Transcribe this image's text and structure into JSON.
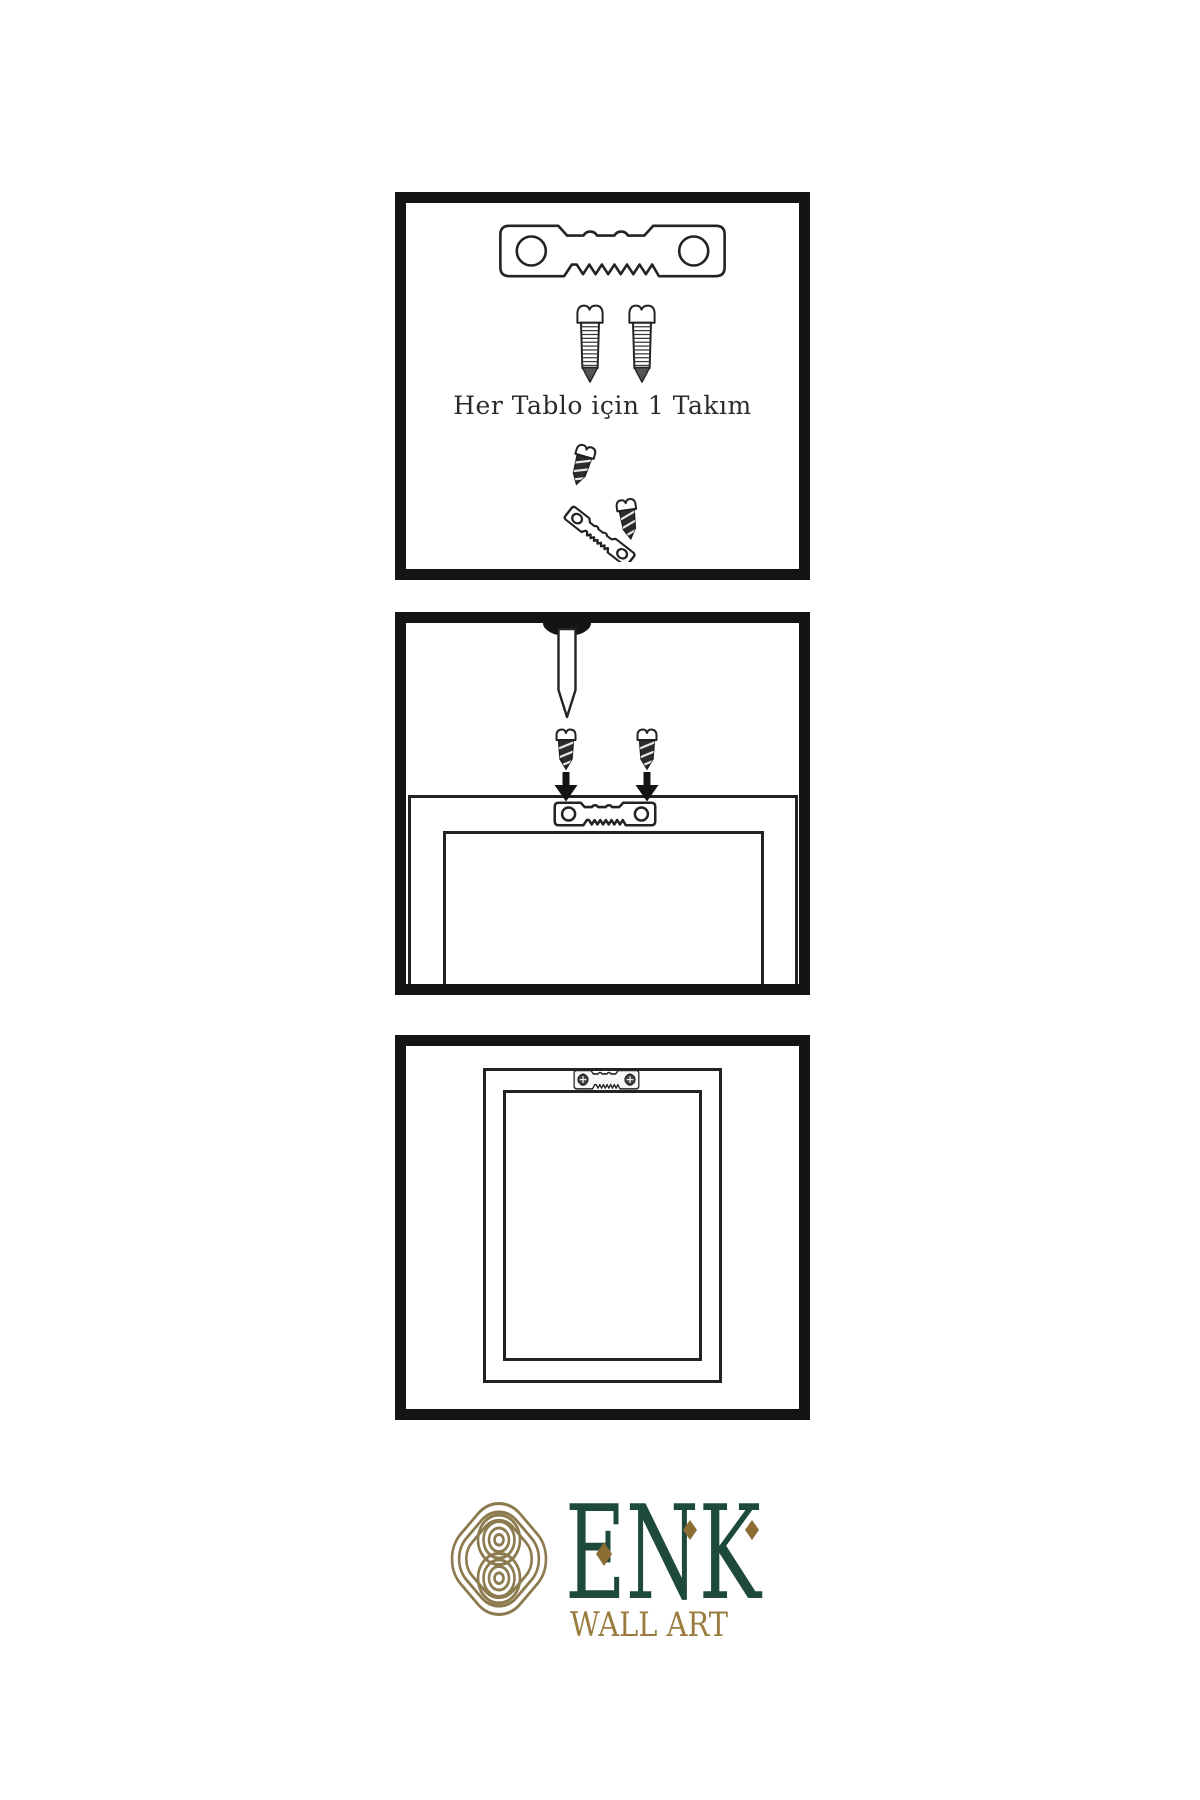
{
  "canvas": {
    "background": "#ffffff",
    "line_color": "#232323",
    "panel_border_color": "#141414"
  },
  "panels": [
    {
      "name": "hardware-kit",
      "caption": "Her Tablo için 1 Takım",
      "items": [
        "sawtooth-hanger",
        "screw",
        "screw",
        "screw-hanger-assembly"
      ]
    },
    {
      "name": "wall-mounting",
      "items": [
        "nail-in-wall",
        "screw-with-down-arrow",
        "screw-with-down-arrow",
        "frame-top-with-sawtooth-hanger"
      ]
    },
    {
      "name": "mounted-frame",
      "items": [
        "frame-back-with-screwed-hanger"
      ]
    }
  ],
  "logo": {
    "brand": "ENK",
    "tagline": "WALL ART",
    "emblem": "interlaced-knot",
    "colors": {
      "brand_green": "#1d4a3c",
      "emblem_gold": "#8c7b4e",
      "tagline_gold": "#9a7c3e",
      "accent_gold": "#8c6d33"
    }
  }
}
